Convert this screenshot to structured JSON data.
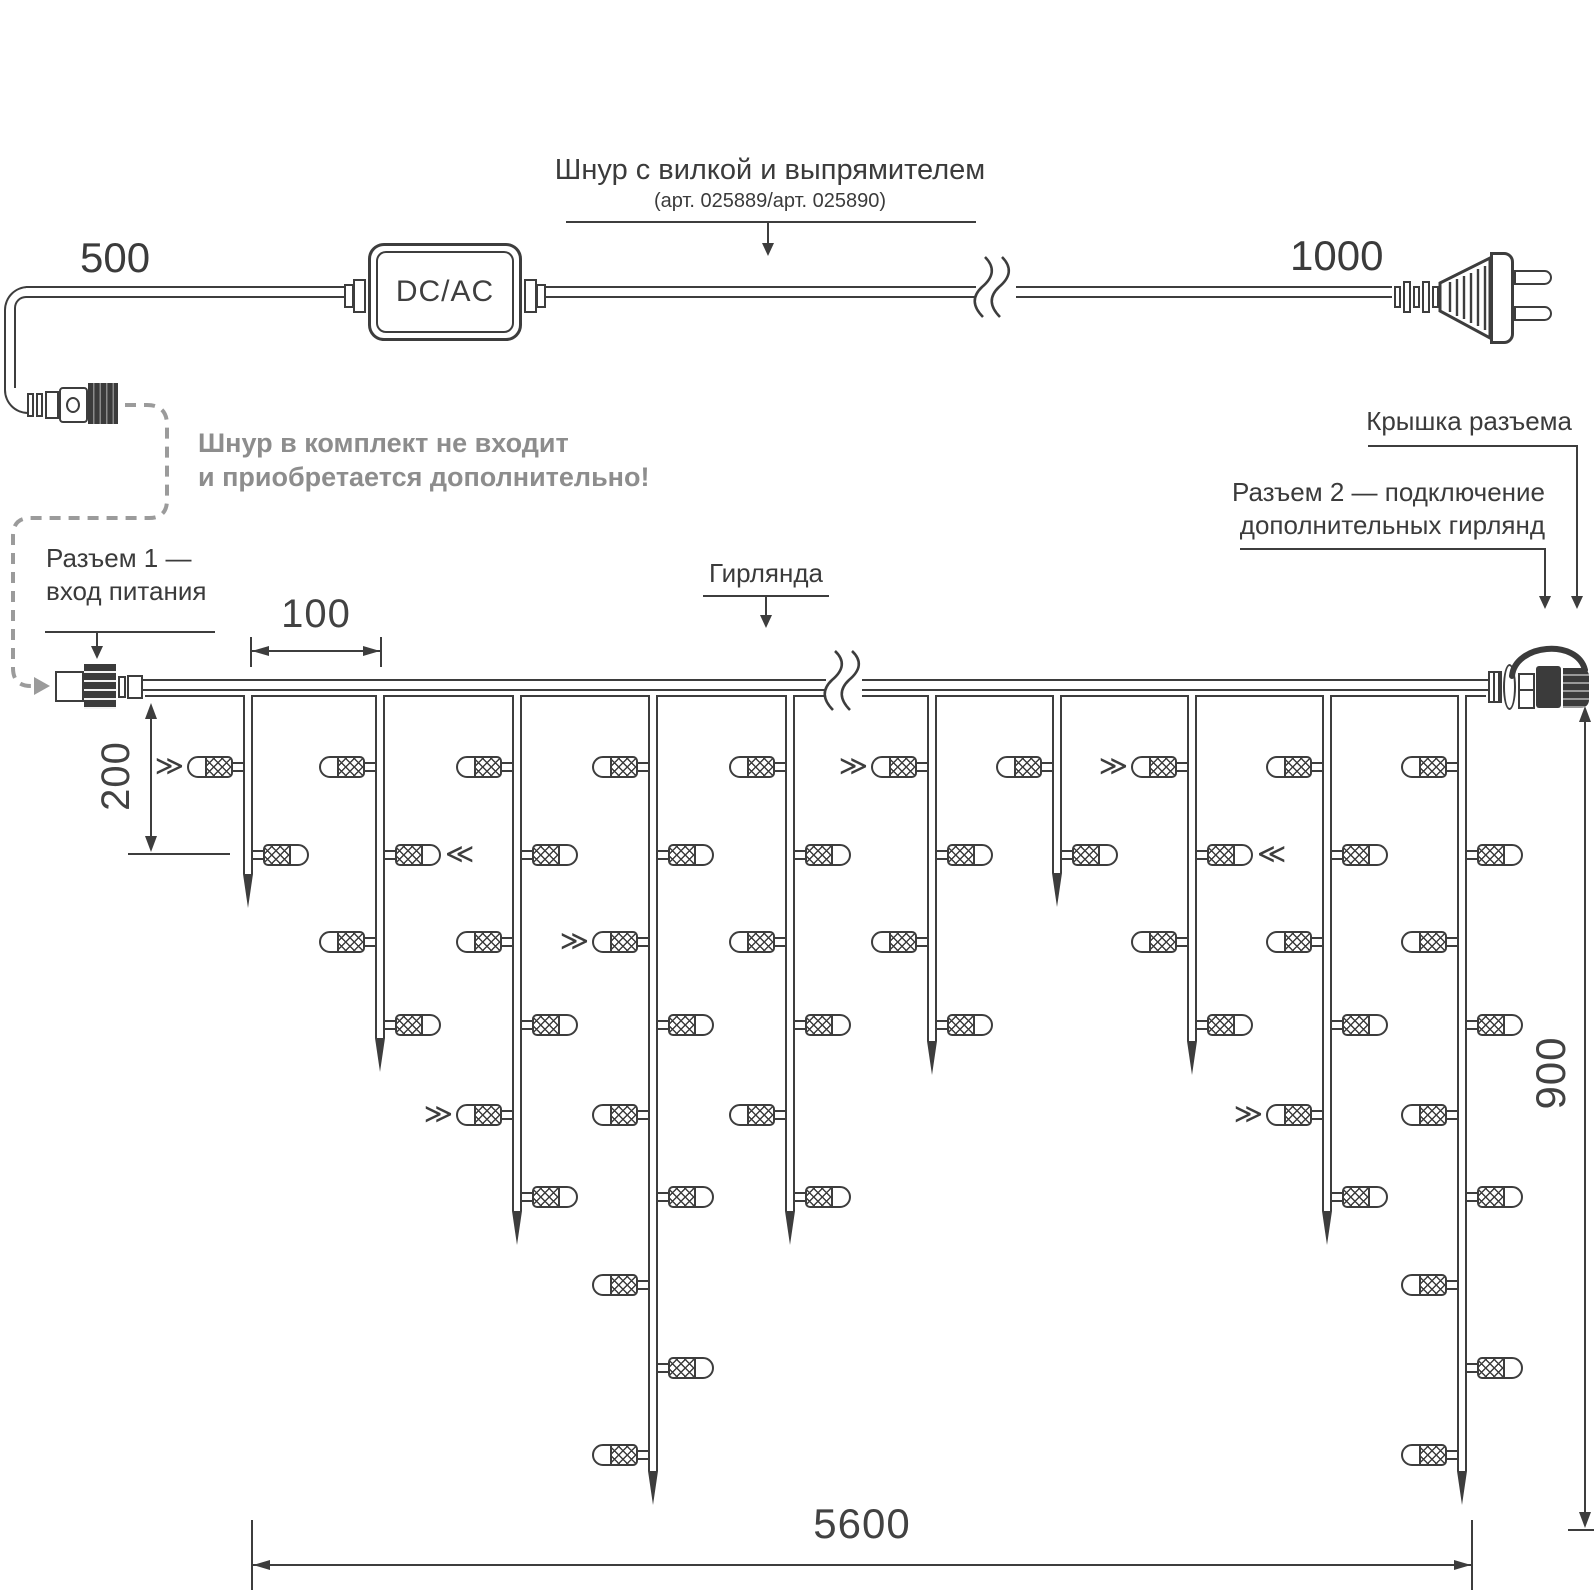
{
  "colors": {
    "line": "#3d3d3d",
    "note_text": "#8d8d8d",
    "dashed": "#9b9b9b"
  },
  "power_cord": {
    "title": "Шнур с вилкой и выпрямителем",
    "subtitle": "(арт. 025889/арт. 025890)",
    "length_left": "500",
    "length_right": "1000",
    "converter_label": "DC/AC"
  },
  "note": {
    "line1": "Шнур в комплект не входит",
    "line2": "и приобретается дополнительно!"
  },
  "callouts": {
    "connector1_line1": "Разъем 1 —",
    "connector1_line2": "вход питания",
    "garland": "Гирлянда",
    "cap": "Крышка разъема",
    "connector2_line1": "Разъем 2 — подключение",
    "connector2_line2": "дополнительных гирлянд"
  },
  "dimensions": {
    "drop_spacing": "100",
    "top_offset": "200",
    "height": "900",
    "total_length": "5600"
  },
  "garland": {
    "wire": {
      "x1": 143,
      "x2": 1488,
      "y": 679,
      "lower_y": 695,
      "break_x1": 826,
      "break_x2": 862
    },
    "levels": [
      767,
      855,
      942,
      1025,
      1115,
      1197,
      1285,
      1368,
      1455
    ],
    "marker_toward_right": "≫",
    "marker_toward_left": "≪",
    "drops": [
      {
        "x": 248,
        "bulbs": 2,
        "tip": 908,
        "marked": [
          1
        ]
      },
      {
        "x": 380,
        "bulbs": 4,
        "tip": 1072,
        "marked": [
          2
        ]
      },
      {
        "x": 517,
        "bulbs": 6,
        "tip": 1245,
        "marked": [
          5
        ]
      },
      {
        "x": 653,
        "bulbs": 9,
        "tip": 1505,
        "marked": [
          3
        ]
      },
      {
        "x": 790,
        "bulbs": 6,
        "tip": 1245,
        "marked": []
      },
      {
        "x": 932,
        "bulbs": 4,
        "tip": 1075,
        "marked": [
          1
        ]
      },
      {
        "x": 1057,
        "bulbs": 2,
        "tip": 907,
        "marked": []
      },
      {
        "x": 1192,
        "bulbs": 4,
        "tip": 1075,
        "marked": [
          1,
          2
        ]
      },
      {
        "x": 1327,
        "bulbs": 6,
        "tip": 1245,
        "marked": [
          5
        ]
      },
      {
        "x": 1462,
        "bulbs": 9,
        "tip": 1505,
        "marked": []
      }
    ]
  }
}
